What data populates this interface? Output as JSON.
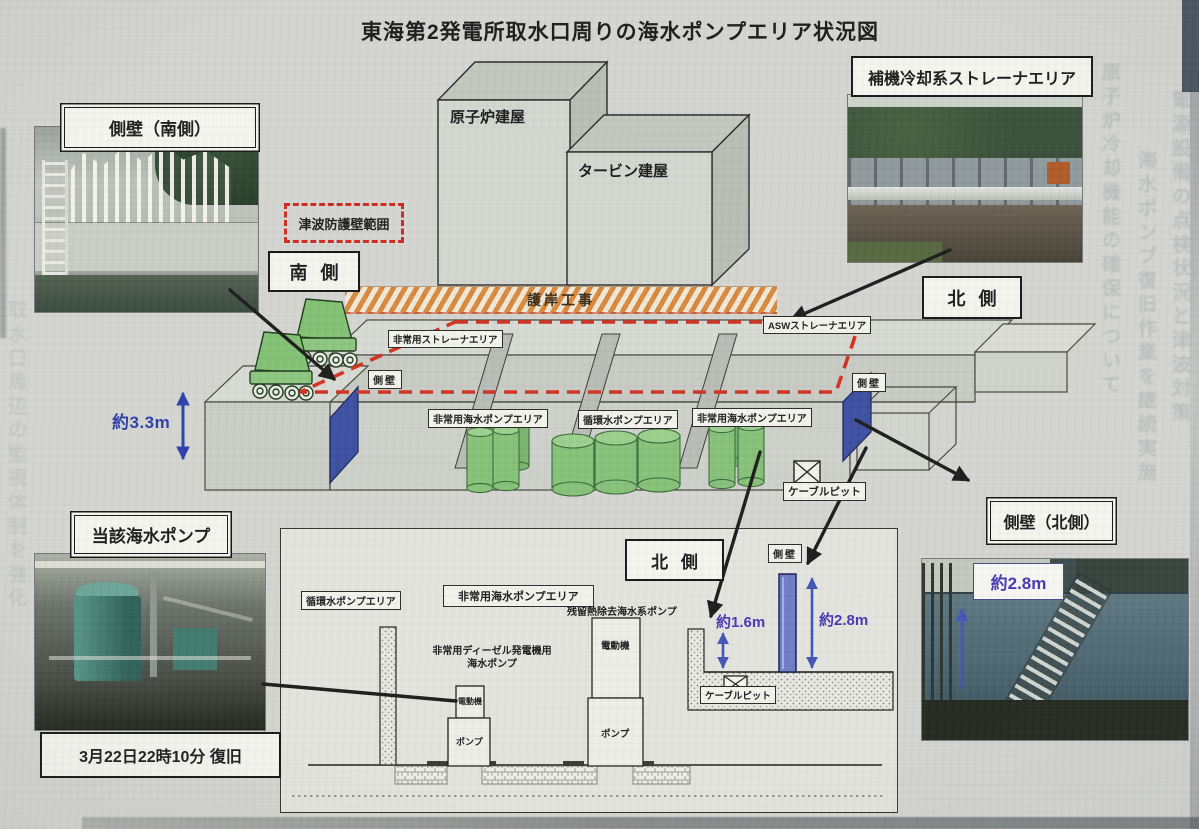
{
  "title": "東海第2発電所取水口周りの海水ポンプエリア状況図",
  "photos": {
    "sidewall_south_label": "側壁（南側）",
    "aux_strainer_label": "補機冷却系ストレーナエリア",
    "subject_pump_label": "当該海水ポンプ",
    "restore_caption": "3月22日22時10分 復旧",
    "sidewall_north_label": "側壁（北側）",
    "sidewall_north_height": "約2.8m"
  },
  "iso": {
    "reactor_building": "原子炉建屋",
    "turbine_building": "タービン建屋",
    "tsunami_wall_range": "津波防護壁範囲",
    "south_side": "南 側",
    "north_side": "北 側",
    "revetment_work": "護岸工事",
    "emergency_strainer_area": "非常用ストレーナエリア",
    "asw_strainer_area": "ASWストレーナエリア",
    "sidewall_left": "側壁",
    "sidewall_right": "側壁",
    "emergency_pump_area_left": "非常用海水ポンプエリア",
    "circulating_pump_area": "循環水ポンプエリア",
    "emergency_pump_area_right": "非常用海水ポンプエリア",
    "cable_pit": "ケーブルピット",
    "height_3_3m": "約3.3m"
  },
  "section": {
    "north_side": "北 側",
    "circulating_pump_area": "循環水ポンプエリア",
    "emergency_pump_area": "非常用海水ポンプエリア",
    "rhr_seawater_pump": "残留熱除去海水系ポンプ",
    "diesel_seawater_pump": "非常用ディーゼル発電機用\n海水ポンプ",
    "motor": "電動機",
    "pump": "ポンプ",
    "sidewall": "側壁",
    "height_1_6m": "約1.6m",
    "height_2_8m": "約2.8m",
    "cable_pit": "ケーブルピット"
  },
  "bleed_text": [
    "原子炉冷却機能の確保について",
    "海水ポンプ復旧作業を継続実施",
    "電源設備の点検状況と津波対策",
    "取水口周辺の監視体制を強化"
  ],
  "colors": {
    "accent_red": "#d23222",
    "measure_blue": "#2b3fa8",
    "measure_purple": "#4638b0",
    "pump_green": "#86c178",
    "wall_blue": "#3c4fa0",
    "revetment_orange": "#d8893e"
  }
}
